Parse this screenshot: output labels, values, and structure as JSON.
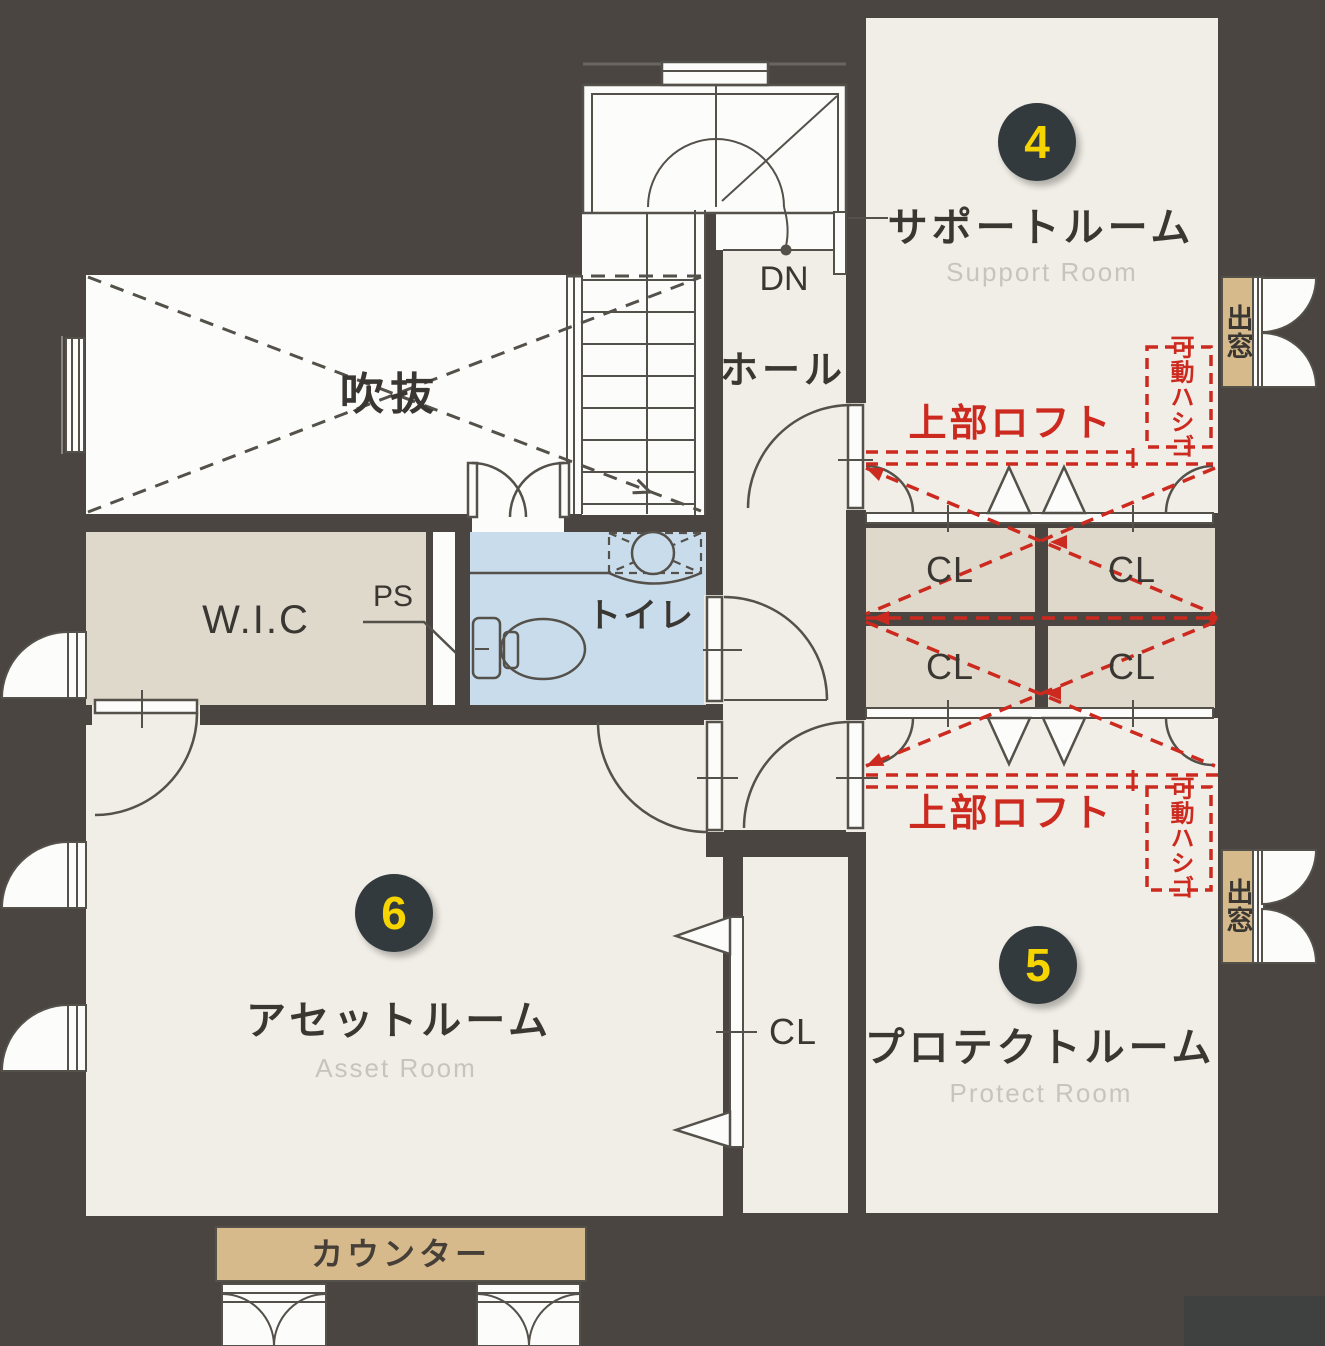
{
  "rooms": {
    "support": {
      "badge": "4",
      "name": "サポートルーム",
      "en": "Support Room"
    },
    "protect": {
      "badge": "5",
      "name": "プロテクトルーム",
      "en": "Protect Room"
    },
    "asset": {
      "badge": "6",
      "name": "アセットルーム",
      "en": "Asset Room"
    },
    "hall": {
      "name": "ホール"
    },
    "void": {
      "name": "吹抜"
    },
    "wic": {
      "name": "W.I.C"
    },
    "toilet": {
      "name": "トイレ"
    },
    "ps": {
      "name": "PS"
    },
    "closet": {
      "abbr": "CL"
    }
  },
  "annotations": {
    "down": "DN",
    "upper_loft": "上部ロフト",
    "movable_ladder": "可動ハシゴ",
    "bay_window": "出窓",
    "counter": "カウンター"
  },
  "colors": {
    "background": "#4a4541",
    "room_cream": "#f1eee7",
    "void_white": "#fcfcfa",
    "closet_beige": "#ded9cb",
    "toilet_blue": "#c9dcec",
    "wood_tan": "#d6ba8c",
    "accent_red": "#cc291f",
    "badge_bg": "#333a3d",
    "badge_number": "#f5d400",
    "line": "#54504a",
    "label": "#3a3733",
    "label_en": "#c7c4c0"
  }
}
